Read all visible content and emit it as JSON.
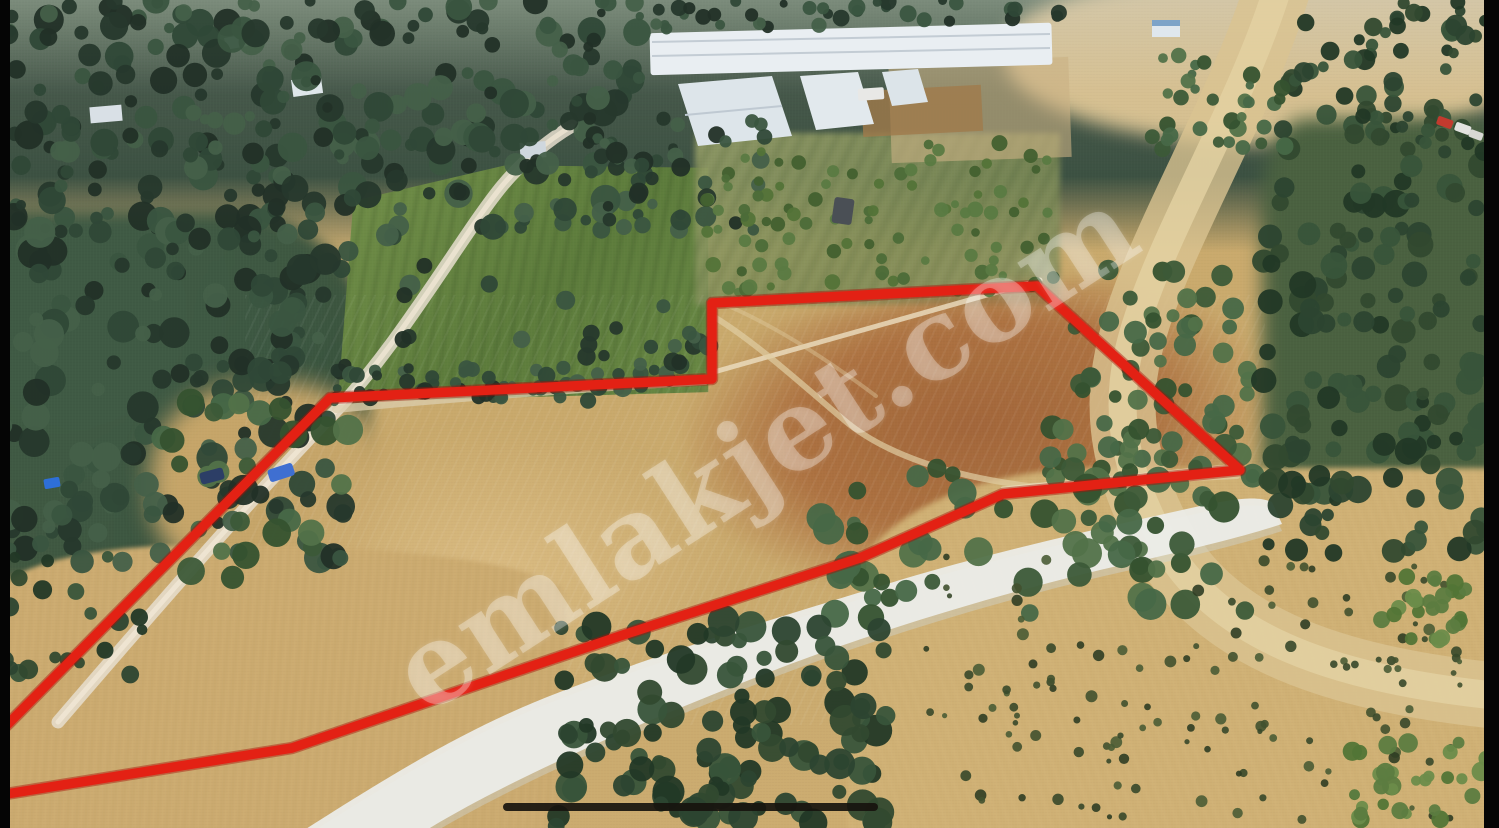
{
  "image": {
    "description": "Aerial drone photograph of Mediterranean farmland with olive groves, greenhouses and dirt roads; a plowed land parcel offered for sale is outlined in red",
    "width": 1499,
    "height": 828
  },
  "watermark": {
    "text": "emlakjet.com",
    "color": "rgba(255,255,255,0.30)",
    "rotation_deg": -33,
    "font_size_px": 112,
    "center_x": 765,
    "center_y": 450
  },
  "parcel_boundary": {
    "stroke_color": "#e32114",
    "stroke_outline_color": "#a80f06",
    "stroke_width": 9.5,
    "points": "-60,790 10,722 330,398 712,379 712,303 1037,286 1240,470 1003,494 860,558 620,636 292,748 0,795 -40,802"
  },
  "frame": {
    "letterbox_color": "#050505",
    "left_bar_width": 10,
    "right_bar_width": 15
  },
  "home_indicator": {
    "color": "#17130e",
    "opacity": 0.92,
    "left": 503,
    "top": 803,
    "width": 375,
    "height": 8,
    "radius": 5
  },
  "palette": {
    "field_tan": "#cbab6f",
    "plowed_red": "#a86538",
    "olive_dark": "#36503b",
    "crop_green": "#678745",
    "chalk_white": "#edeeea",
    "greenhouse_white": "#e9eef2"
  }
}
